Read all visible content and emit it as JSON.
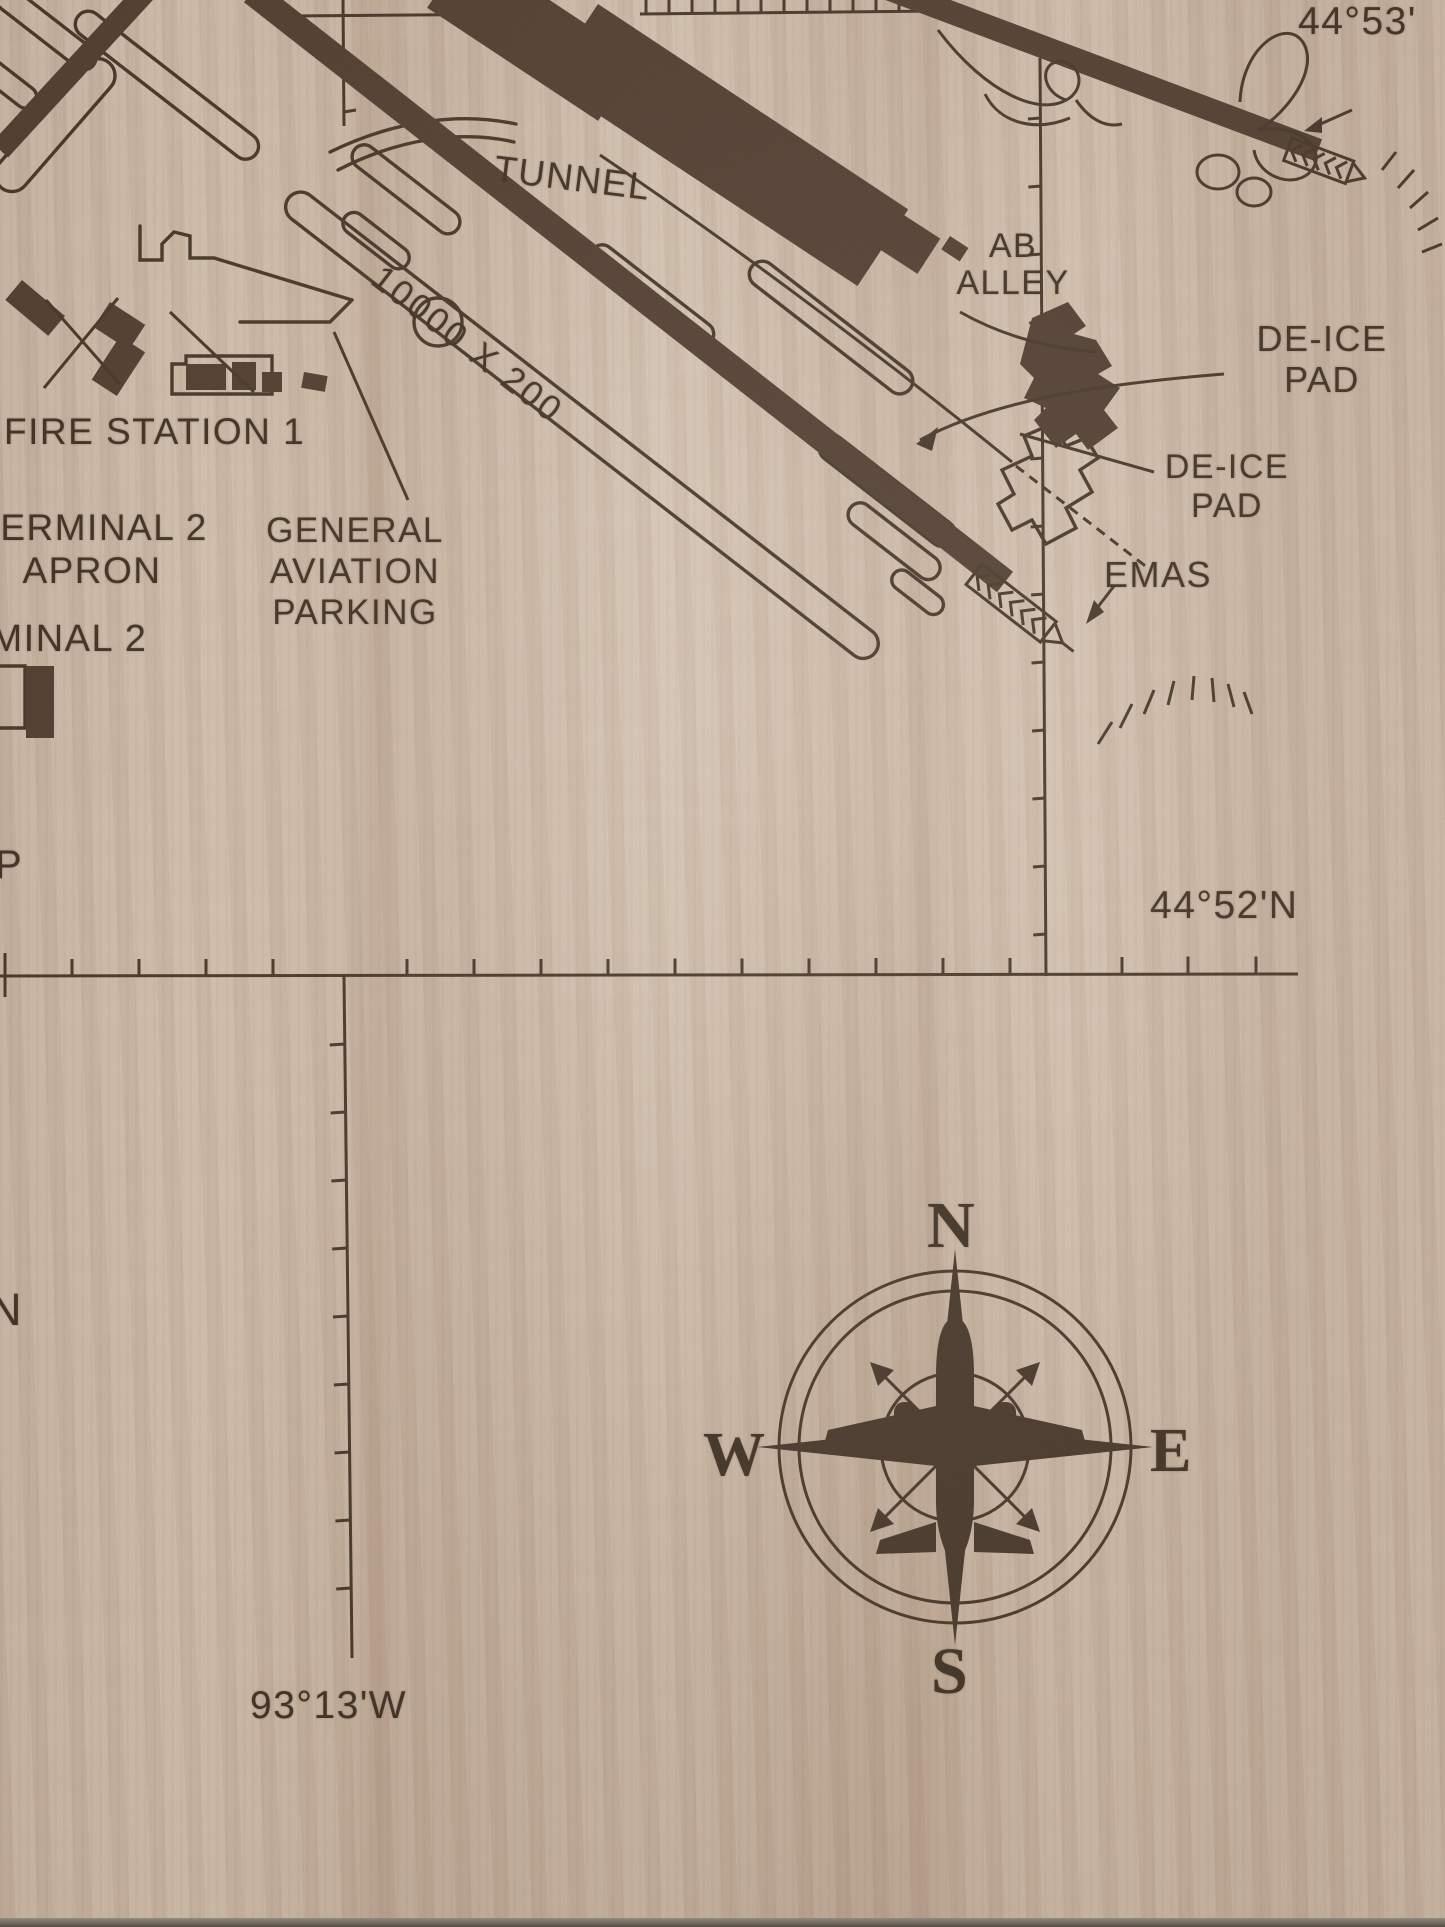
{
  "colors": {
    "wood_light": "#dccab8",
    "wood_mid": "#cfbcaa",
    "wood_dark_streak": "#b9a391",
    "engraving": "#3c2d20",
    "engraving_fill": "#473528"
  },
  "geo_grid": {
    "lat_top": "44°53'",
    "lat_mid": "44°52'N",
    "lon_bottom": "93°13'W"
  },
  "airport": {
    "tunnel": "TUNNEL",
    "ab_alley": [
      "AB",
      "ALLEY"
    ],
    "deice_pad_upper": [
      "DE-ICE",
      "PAD"
    ],
    "deice_pad_lower": [
      "DE-ICE",
      "PAD"
    ],
    "emas": "EMAS",
    "fire_station": "FIRE STATION 1",
    "terminal2_apron": [
      "TERMINAL 2",
      "APRON"
    ],
    "general_aviation": [
      "GENERAL",
      "AVIATION",
      "PARKING"
    ],
    "terminal2": "TERMINAL 2",
    "parking_p": "P",
    "edge_n": "N",
    "runway_dimension": "10000 X 200"
  },
  "compass": {
    "n": "N",
    "e": "E",
    "s": "S",
    "w": "W"
  }
}
